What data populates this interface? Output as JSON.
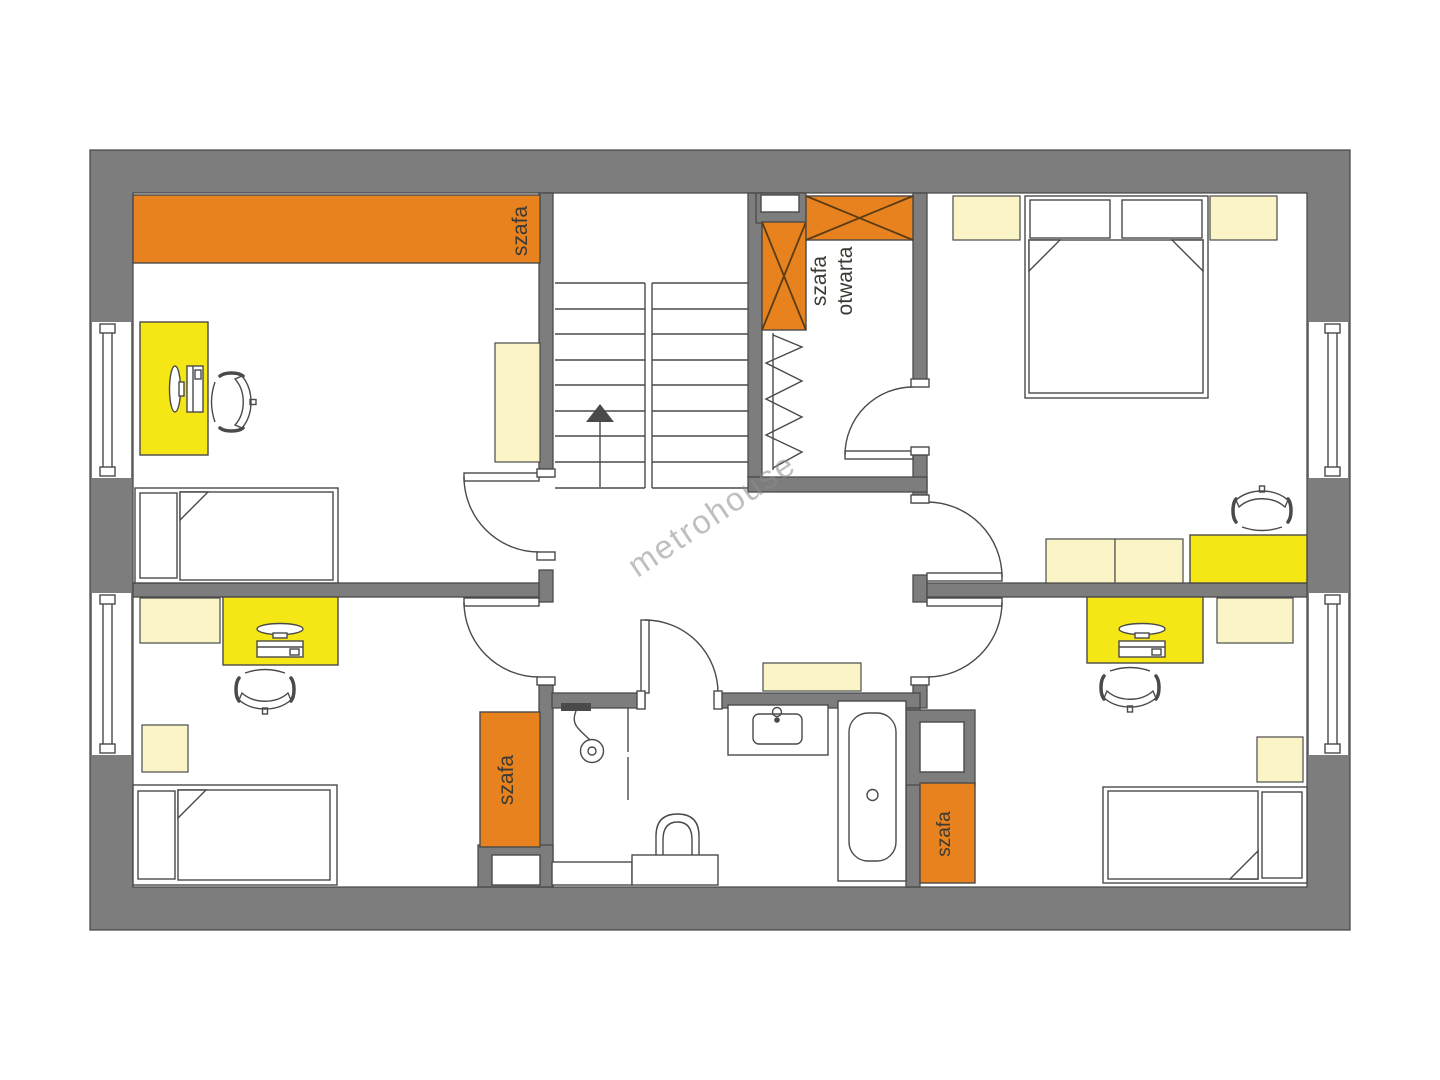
{
  "watermark": {
    "text": "metrohouse"
  },
  "labels": {
    "wardrobe_top_left": "szafa",
    "open_wardrobe_line1": "szafa",
    "open_wardrobe_line2": "otwarta",
    "wardrobe_bottom_left": "szafa",
    "wardrobe_bottom_right": "szafa"
  },
  "colors": {
    "wall": "#7d7d7d",
    "line": "#4a4a4a",
    "orange": "#e8821e",
    "yellow": "#f5e716",
    "cream": "#faf4c6",
    "label": "#3c3a33",
    "watermark": "#8c8c8c",
    "xline": "#5a3c14"
  }
}
